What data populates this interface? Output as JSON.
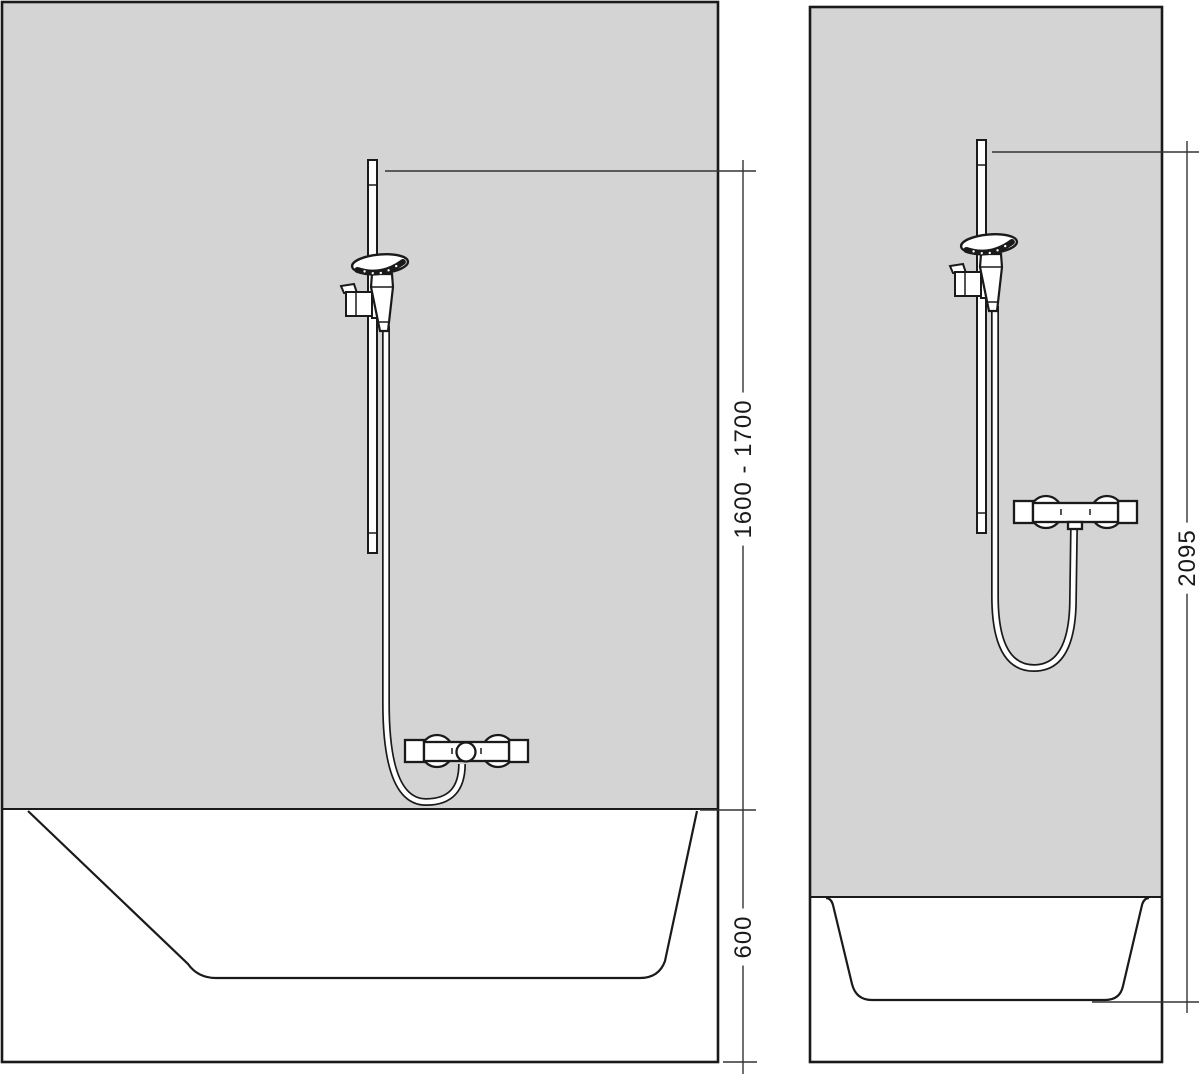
{
  "diagram": {
    "kind": "shower-set-installation-drawing",
    "front_view": {
      "name": "front-view-with-bathtub",
      "dimensions": [
        {
          "id": "tub-rim-to-rail-top",
          "label": "1600 - 1700"
        },
        {
          "id": "floor-to-tub-rim",
          "label": "600"
        }
      ],
      "parts": [
        "wall",
        "bathtub",
        "shower-rail",
        "hand-shower",
        "shower-holder",
        "shower-hose",
        "thermostat-mixer"
      ]
    },
    "side_view": {
      "name": "side-view-with-shower-tray",
      "dimensions": [
        {
          "id": "tray-floor-to-rail-top",
          "label": "2095"
        }
      ],
      "parts": [
        "wall",
        "shower-tray",
        "shower-rail",
        "hand-shower",
        "shower-holder",
        "shower-hose",
        "thermostat-mixer"
      ]
    },
    "colors": {
      "background": "#ffffff",
      "wall_fill": "#d4d4d4",
      "outline": "#1a1a1a",
      "dimension": "#333333"
    }
  }
}
